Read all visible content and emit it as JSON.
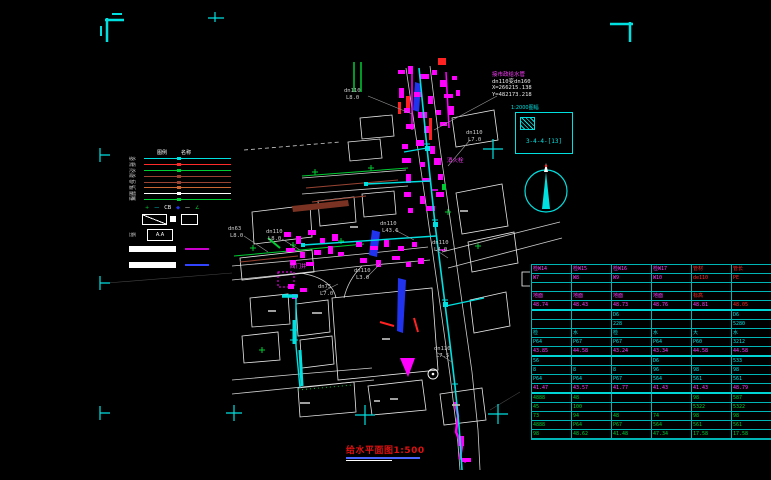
{
  "title": {
    "text": "给水平面图1:500"
  },
  "info_block": {
    "lines": [
      "接市政给水管",
      "dn110变dn160",
      "X=266215.138",
      "Y=482173.218"
    ]
  },
  "sheet_index": {
    "caption": "1:2000图幅",
    "code": "3-4-4-[13]"
  },
  "legend": {
    "headers": [
      "图例",
      "名称"
    ],
    "lines": [
      {
        "label": "给水",
        "color": "#00e0e0",
        "dash": "solid"
      },
      {
        "label": "消防",
        "color": "#ff2a2a",
        "dash": "solid"
      },
      {
        "label": "污水",
        "color": "#00cc33",
        "dash": "solid"
      },
      {
        "label": "雨水",
        "color": "#994433",
        "dash": "solid"
      },
      {
        "label": "电力",
        "color": "#994433",
        "dash": "solid"
      },
      {
        "label": "燃气",
        "color": "#cc6633",
        "dash": "solid"
      },
      {
        "label": "围墙",
        "color": "#ffffff",
        "dash": "dashed"
      },
      {
        "label": "绿篱",
        "color": "#00cc33",
        "dash": "dotted"
      }
    ],
    "symbols": [
      {
        "glyph": "+",
        "color": "#00cc33"
      },
      {
        "glyph": "—",
        "color": "#00e0e0"
      },
      {
        "glyph": "CB",
        "color": "#ffffff"
      },
      {
        "glyph": "◆",
        "color": "#2233ee"
      },
      {
        "glyph": "—",
        "color": "#ffffff"
      },
      {
        "glyph": "∠",
        "color": "#00cc33"
      }
    ],
    "ratio_label": "比例",
    "ratio_value": "A.A",
    "scalebar_colors": [
      "#cc00cc",
      "#3344ff"
    ]
  },
  "map": {
    "labels": [
      {
        "t": "dn110",
        "x": 344,
        "y": 92
      },
      {
        "t": "L8.0",
        "x": 346,
        "y": 99
      },
      {
        "t": "dn110",
        "x": 466,
        "y": 134
      },
      {
        "t": "L7.0",
        "x": 468,
        "y": 141
      },
      {
        "t": "dn63",
        "x": 228,
        "y": 230
      },
      {
        "t": "L8.0",
        "x": 230,
        "y": 237
      },
      {
        "t": "dn110",
        "x": 266,
        "y": 233
      },
      {
        "t": "L8.0",
        "x": 268,
        "y": 240
      },
      {
        "t": "dn110",
        "x": 380,
        "y": 225
      },
      {
        "t": "L43.6",
        "x": 382,
        "y": 232
      },
      {
        "t": "dn110",
        "x": 432,
        "y": 244
      },
      {
        "t": "L4.0",
        "x": 434,
        "y": 251
      },
      {
        "t": "dn75",
        "x": 318,
        "y": 288
      },
      {
        "t": "L7.0",
        "x": 320,
        "y": 295
      },
      {
        "t": "dn110",
        "x": 354,
        "y": 272
      },
      {
        "t": "L3.0",
        "x": 356,
        "y": 279
      },
      {
        "t": "dn110",
        "x": 434,
        "y": 350
      },
      {
        "t": "L7.5",
        "x": 436,
        "y": 357
      },
      {
        "t": "消火栓",
        "x": 447,
        "y": 162,
        "c": "#ff3dff"
      },
      {
        "t": "阀门井",
        "x": 290,
        "y": 268,
        "c": "#ff3dff"
      }
    ]
  },
  "table": {
    "rows": [
      {
        "c": "m",
        "cells": [
          "检W14",
          "检W15",
          "检W16",
          "检W17",
          "管材",
          "管长"
        ],
        "ov": {
          "4": "r",
          "5": "r"
        }
      },
      {
        "c": "m",
        "cells": [
          "W7",
          "W8",
          "W9",
          "W10",
          "de110",
          "PE"
        ],
        "ov": {
          "4": "r",
          "5": "r"
        }
      },
      {
        "c": "m",
        "cells": [
          "",
          "",
          "",
          "",
          "",
          ""
        ]
      },
      {
        "c": "m",
        "cells": [
          "地面",
          "地面",
          "地面",
          "地面",
          "标高",
          ""
        ],
        "ov": {
          "4": "r"
        }
      },
      {
        "c": "m",
        "cells": [
          "48.74",
          "48.43",
          "48.73",
          "48.76",
          "48.81",
          "48.05"
        ],
        "ov": {
          "5": "r"
        },
        "sep": true
      },
      {
        "c": "c",
        "cells": [
          "",
          "",
          "D6",
          "",
          "",
          "D6"
        ]
      },
      {
        "c": "c",
        "cells": [
          "",
          "",
          "228",
          "",
          "",
          "5280"
        ]
      },
      {
        "c": "c",
        "cells": [
          "检",
          "水",
          "检",
          "水",
          "大",
          "水"
        ]
      },
      {
        "c": "c",
        "cells": [
          "P64",
          "P67",
          "P67",
          "P64",
          "P60",
          "3212"
        ]
      },
      {
        "c": "m",
        "cells": [
          "43.85",
          "44.58",
          "43.24",
          "43.34",
          "44.58",
          "44.58"
        ],
        "sep": true
      },
      {
        "c": "c",
        "cells": [
          "56",
          "",
          "",
          "D6",
          "",
          "533"
        ]
      },
      {
        "c": "c",
        "cells": [
          "8",
          "8",
          "8",
          "96",
          "98",
          "98"
        ]
      },
      {
        "c": "c",
        "cells": [
          "P64",
          "P64",
          "P67",
          "564",
          "561",
          "561"
        ]
      },
      {
        "c": "m",
        "cells": [
          "41.47",
          "43.57",
          "41.77",
          "41.43",
          "41.43",
          "48.79"
        ],
        "sep": true
      },
      {
        "c": "g",
        "cells": [
          "4888",
          "48",
          "",
          "",
          "98",
          "587"
        ]
      },
      {
        "c": "g",
        "cells": [
          "45",
          "100",
          "",
          "",
          "5322",
          "5322"
        ]
      },
      {
        "c": "g",
        "cells": [
          "73",
          "94",
          "48",
          "74",
          "98",
          "98"
        ]
      },
      {
        "c": "g",
        "cells": [
          "4888",
          "P64",
          "P67",
          "564",
          "561",
          "561"
        ]
      },
      {
        "c": "g",
        "cells": [
          "98",
          "48.62",
          "41.48",
          "47.34",
          "17.58",
          "17.58"
        ]
      }
    ],
    "text_colors": {
      "m": "#ff3dff",
      "c": "#00e0e0",
      "r": "#ff2a2a",
      "g": "#00cc33",
      "w": "#ffffff"
    }
  },
  "colors": {
    "background": "#000000",
    "registration": "#00e0e0",
    "pipe_main": "#00e0e0",
    "annotation": "#ff00ff",
    "roads": "#cfcfcf",
    "vegetation": "#00cc33",
    "fire": "#ff2222",
    "storm": "#994433",
    "special": "#2233ee",
    "title_red": "#e01010"
  }
}
